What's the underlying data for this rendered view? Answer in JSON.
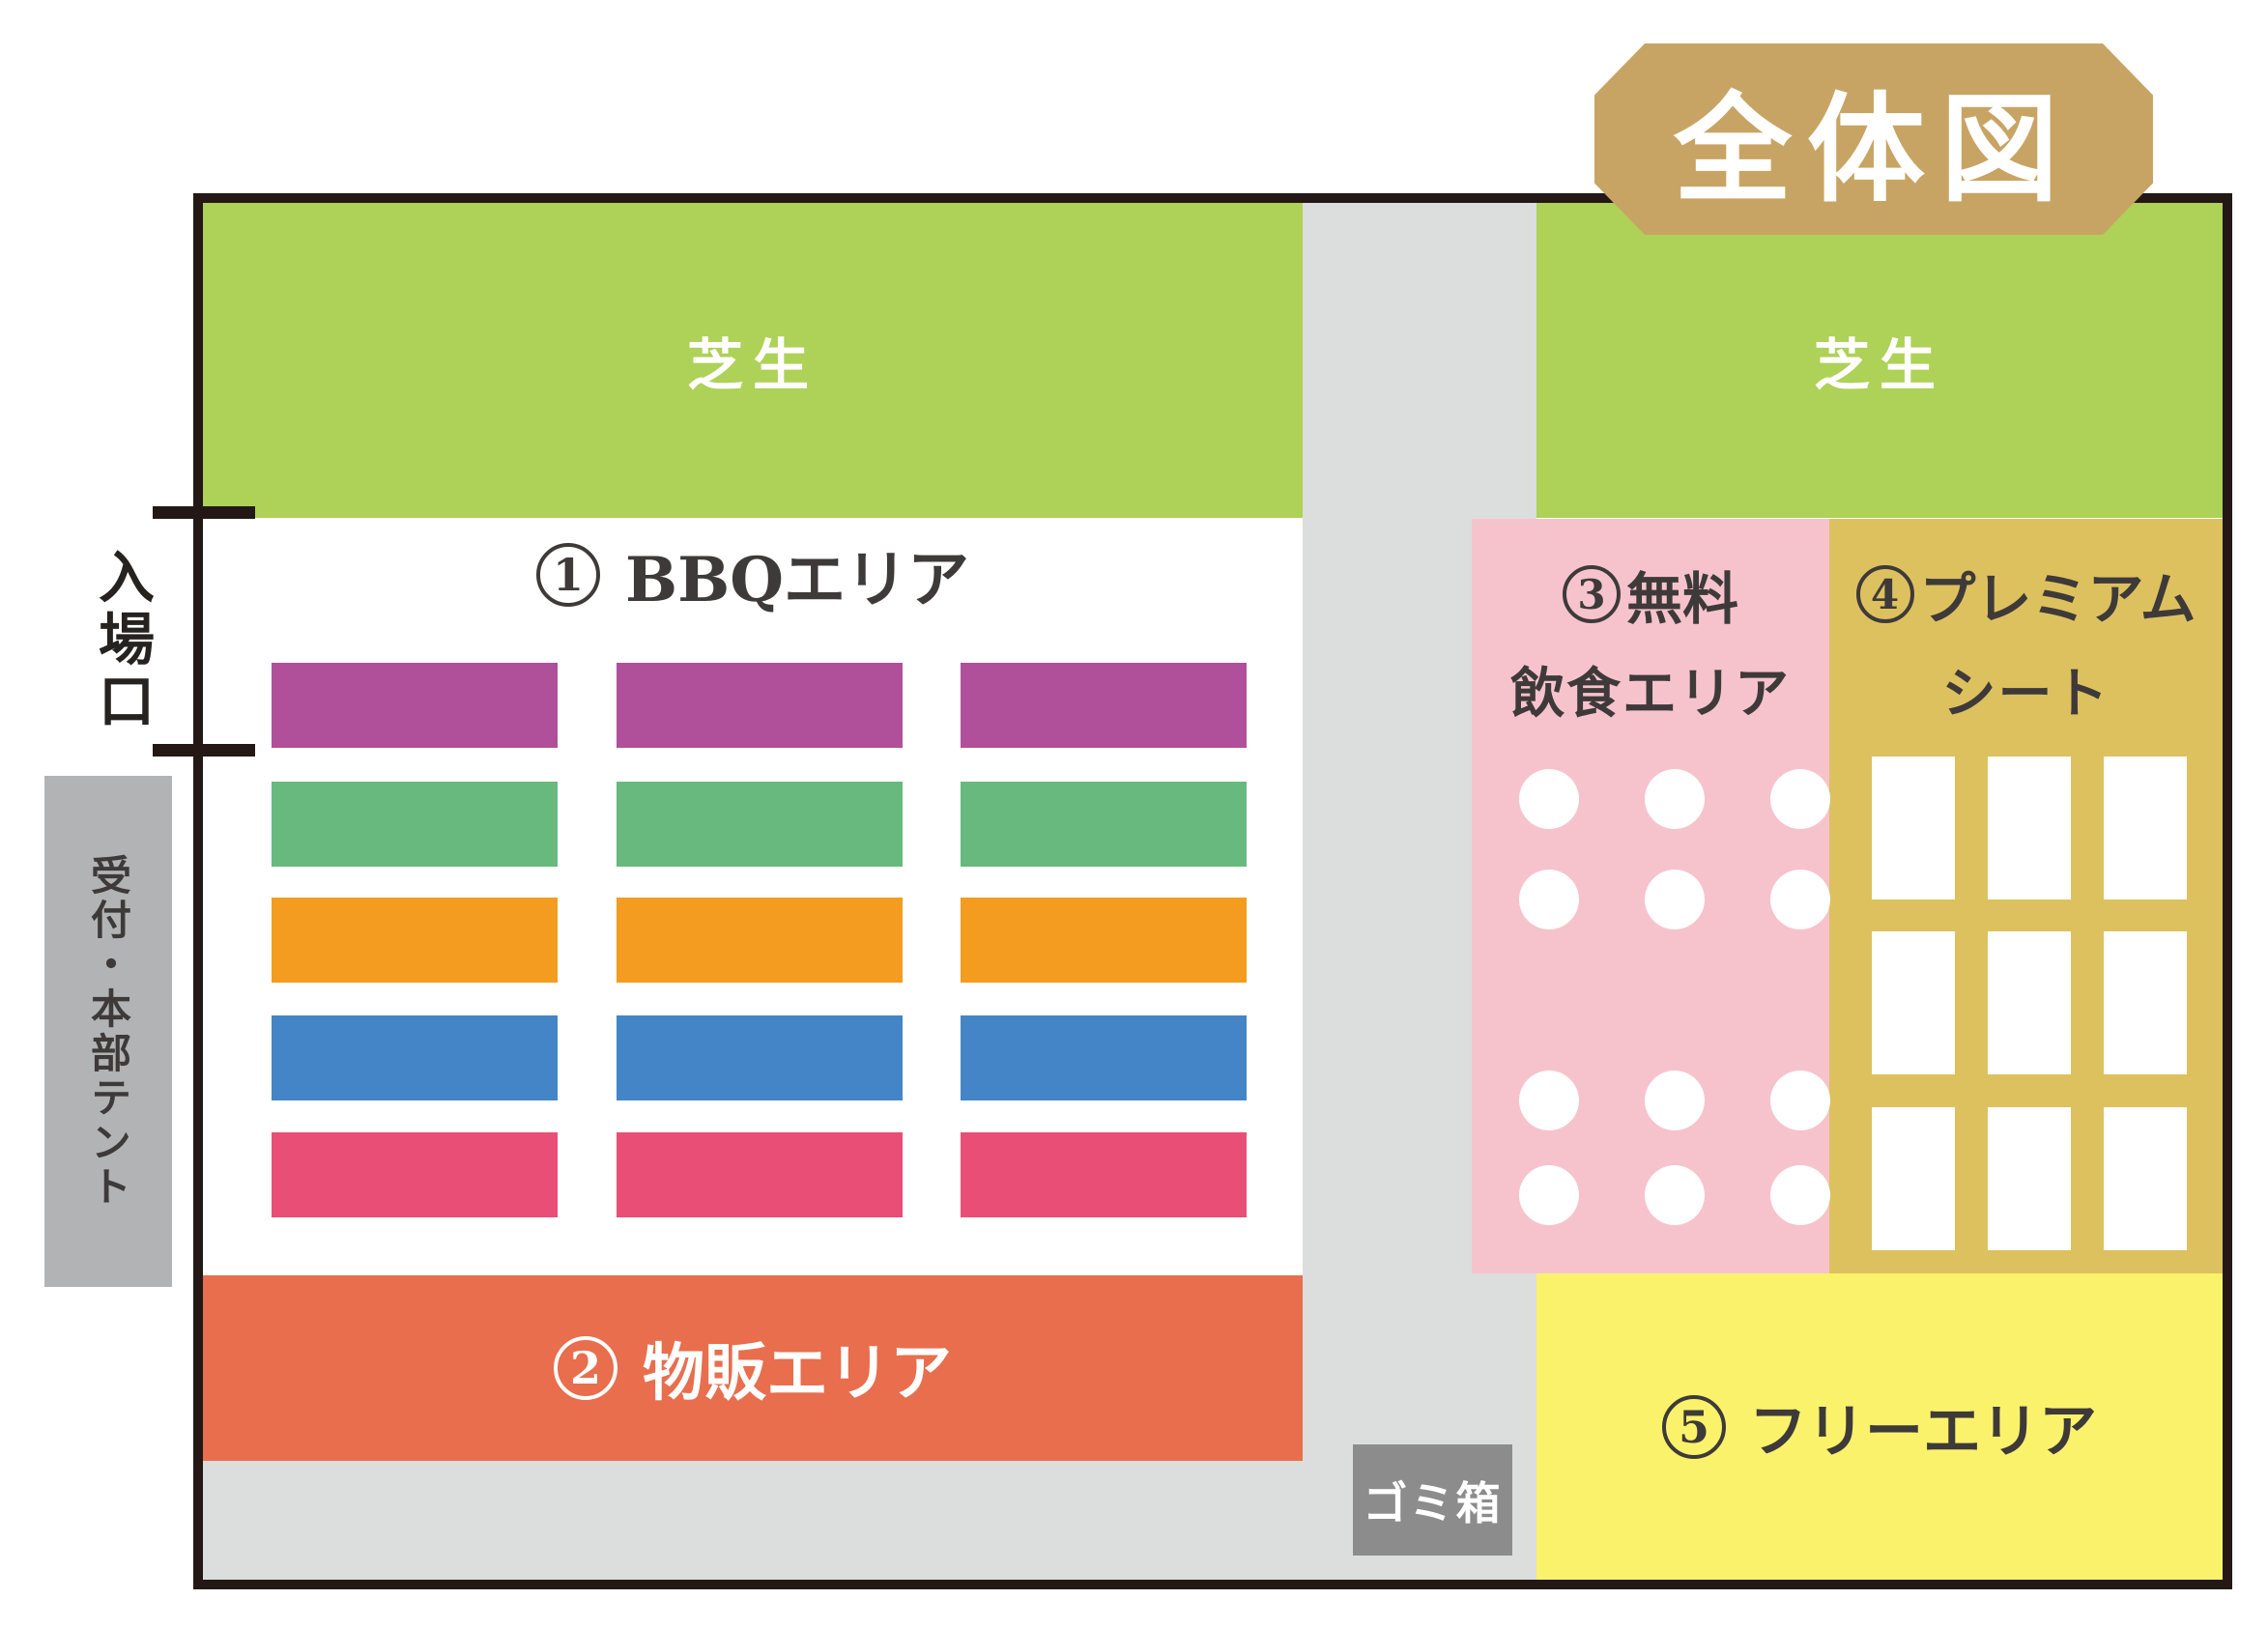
{
  "title": "全体図",
  "map": {
    "lawn_top_left": "芝生",
    "lawn_top_right": "芝生",
    "bbq": {
      "num": "1",
      "label": "BBQエリア"
    },
    "merch": {
      "num": "2",
      "label": "物販エリア"
    },
    "free_food": {
      "num": "3",
      "line1": "無料",
      "line2": "飲食エリア"
    },
    "premium": {
      "num": "4",
      "line1": "プレミアム",
      "line2": "シート"
    },
    "free_area": {
      "num": "5",
      "label": "フリーエリア"
    },
    "entrance": "入場口",
    "reception": "受付・本部テント",
    "trash": "ゴミ箱"
  },
  "colors": {
    "frame_border": "#231815",
    "lawn_green": "#aed158",
    "path_gray": "#dcdddd",
    "badge_tan": "#c8a464",
    "pink_area": "#f6c3cd",
    "gold_area": "#ddc15f",
    "yellow_area": "#faf26b",
    "orange_area": "#e86e4d",
    "reception_gray": "#b2b3b4",
    "trash_gray": "#8c8c8c",
    "text_dark": "#3e3a39",
    "text_white": "#ffffff",
    "bbq_rows": [
      "#b0509b",
      "#68b97e",
      "#f39c1f",
      "#4385c6",
      "#e94e76"
    ]
  }
}
